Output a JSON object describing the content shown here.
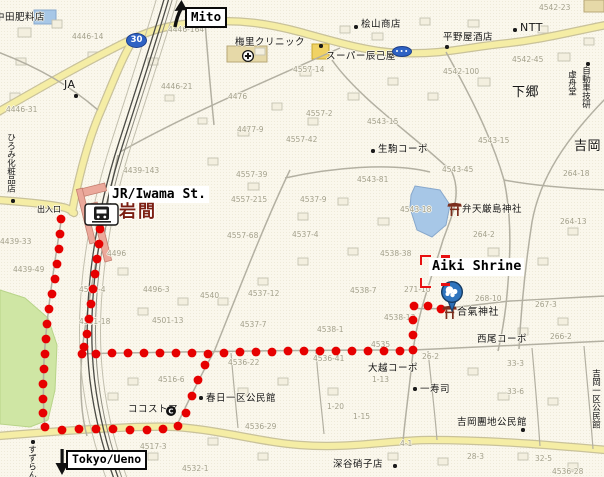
{
  "map": {
    "labels": {
      "station_en": "JR/Iwama St.",
      "shrine_en": "Aiki Shrine",
      "north": "Mito",
      "south": "Tokyo/Ueno",
      "station_jp": "岩間",
      "entrance": "出入口"
    },
    "badges": {
      "route_30": "30"
    },
    "colors": {
      "route_dot": "#e60000",
      "road_yellow": "#f5eda5",
      "water": "#a7c7e7",
      "park": "#cfe6a4",
      "rail": "#4b4b45",
      "station_name": "#7b1e12",
      "badge_blue": "#2e62c4"
    },
    "pois": [
      {
        "text": "中田肥料店",
        "x": -5,
        "y": 13
      },
      {
        "text": "JA",
        "x": 64,
        "y": 79,
        "size": 11,
        "dot": [
          76,
          96
        ]
      },
      {
        "text": "桧山商店",
        "x": 361,
        "y": 20,
        "dot": [
          356,
          27
        ]
      },
      {
        "text": "スーパー辰己屋",
        "x": 326,
        "y": 52,
        "dot": [
          321,
          46
        ]
      },
      {
        "text": "平野屋酒店",
        "x": 443,
        "y": 33,
        "dot": [
          447,
          47
        ]
      },
      {
        "text": "NTT",
        "x": 520,
        "y": 22,
        "size": 11,
        "dot": [
          515,
          30
        ]
      },
      {
        "text": "梅里クリニック",
        "x": 235,
        "y": 38
      },
      {
        "text": "下郷",
        "x": 512,
        "y": 86,
        "size": 13
      },
      {
        "text": "自動車技研",
        "x": 581,
        "y": 66,
        "v": true,
        "size": 8.5,
        "dot": [
          588,
          64
        ]
      },
      {
        "text": "虚舟堂",
        "x": 567,
        "y": 70,
        "v": true,
        "size": 8.5
      },
      {
        "text": "吉岡",
        "x": 574,
        "y": 140,
        "size": 13
      },
      {
        "text": "生駒コーポ",
        "x": 378,
        "y": 145,
        "dot": [
          373,
          151
        ]
      },
      {
        "text": "ひろみ化粧品店",
        "x": 6,
        "y": 133,
        "v": true,
        "size": 8.5,
        "dot": [
          13,
          201
        ]
      },
      {
        "text": "弁天厳島神社",
        "x": 462,
        "y": 205
      },
      {
        "text": "合氣神社",
        "x": 457,
        "y": 308,
        "size": 10
      },
      {
        "text": "西尾コーポ",
        "x": 477,
        "y": 335
      },
      {
        "text": "大越コーポ",
        "x": 368,
        "y": 364
      },
      {
        "text": "一寿司",
        "x": 420,
        "y": 385,
        "dot": [
          415,
          389
        ]
      },
      {
        "text": "吉岡團地公民館",
        "x": 457,
        "y": 418,
        "dot": [
          523,
          430
        ]
      },
      {
        "text": "吉岡一区公民館",
        "x": 591,
        "y": 369,
        "v": true,
        "size": 8.5
      },
      {
        "text": "春日一区公民館",
        "x": 206,
        "y": 394,
        "dot": [
          201,
          398
        ]
      },
      {
        "text": "ココストア",
        "x": 128,
        "y": 405
      },
      {
        "text": "深谷硝子店",
        "x": 333,
        "y": 460,
        "dot": [
          395,
          466
        ]
      },
      {
        "text": "すずらん",
        "x": 27,
        "y": 445,
        "v": true,
        "size": 8.5,
        "dot": [
          33,
          442
        ]
      }
    ],
    "plot_numbers": [
      {
        "text": "4446-14",
        "x": 72,
        "y": 33
      },
      {
        "text": "4446-164",
        "x": 168,
        "y": 26
      },
      {
        "text": "4446-21",
        "x": 161,
        "y": 83
      },
      {
        "text": "4476",
        "x": 228,
        "y": 93
      },
      {
        "text": "4446-31",
        "x": 6,
        "y": 106
      },
      {
        "text": "4557-14",
        "x": 293,
        "y": 66
      },
      {
        "text": "4557-2",
        "x": 306,
        "y": 110
      },
      {
        "text": "4542-23",
        "x": 539,
        "y": 4
      },
      {
        "text": "4542-45",
        "x": 512,
        "y": 56
      },
      {
        "text": "4542-100",
        "x": 443,
        "y": 68
      },
      {
        "text": "4439-143",
        "x": 123,
        "y": 167
      },
      {
        "text": "4477-9",
        "x": 237,
        "y": 126
      },
      {
        "text": "4557-42",
        "x": 286,
        "y": 136
      },
      {
        "text": "4557-39",
        "x": 236,
        "y": 171
      },
      {
        "text": "4557-215",
        "x": 231,
        "y": 196
      },
      {
        "text": "4557-68",
        "x": 227,
        "y": 232
      },
      {
        "text": "4543-15",
        "x": 367,
        "y": 118
      },
      {
        "text": "4543-15",
        "x": 478,
        "y": 137
      },
      {
        "text": "4543-81",
        "x": 357,
        "y": 176
      },
      {
        "text": "4543-45",
        "x": 442,
        "y": 166
      },
      {
        "text": "4543-18",
        "x": 400,
        "y": 206
      },
      {
        "text": "4537-9",
        "x": 300,
        "y": 196
      },
      {
        "text": "4537-4",
        "x": 292,
        "y": 231
      },
      {
        "text": "264-18",
        "x": 563,
        "y": 170
      },
      {
        "text": "264-13",
        "x": 560,
        "y": 218
      },
      {
        "text": "264-2",
        "x": 473,
        "y": 231
      },
      {
        "text": "4538-38",
        "x": 380,
        "y": 250
      },
      {
        "text": "271-10",
        "x": 404,
        "y": 286
      },
      {
        "text": "268-10",
        "x": 475,
        "y": 295
      },
      {
        "text": "267-3",
        "x": 535,
        "y": 301
      },
      {
        "text": "266-2",
        "x": 550,
        "y": 333
      },
      {
        "text": "26-2",
        "x": 422,
        "y": 353
      },
      {
        "text": "4538-13",
        "x": 384,
        "y": 314
      },
      {
        "text": "4538-7",
        "x": 350,
        "y": 287
      },
      {
        "text": "4538-1",
        "x": 317,
        "y": 326
      },
      {
        "text": "4535",
        "x": 371,
        "y": 341
      },
      {
        "text": "4536-41",
        "x": 313,
        "y": 355
      },
      {
        "text": "4536-22",
        "x": 228,
        "y": 359
      },
      {
        "text": "4516-6",
        "x": 158,
        "y": 376
      },
      {
        "text": "4536-29",
        "x": 245,
        "y": 423
      },
      {
        "text": "4517-3",
        "x": 140,
        "y": 443
      },
      {
        "text": "4532-1",
        "x": 182,
        "y": 465
      },
      {
        "text": "4536-28",
        "x": 552,
        "y": 468
      },
      {
        "text": "33-3",
        "x": 507,
        "y": 360
      },
      {
        "text": "33-6",
        "x": 507,
        "y": 388
      },
      {
        "text": "1-13",
        "x": 372,
        "y": 376
      },
      {
        "text": "1-20",
        "x": 327,
        "y": 403
      },
      {
        "text": "1-15",
        "x": 353,
        "y": 413
      },
      {
        "text": "4-1",
        "x": 400,
        "y": 440
      },
      {
        "text": "28-3",
        "x": 467,
        "y": 453
      },
      {
        "text": "32-5",
        "x": 535,
        "y": 455
      },
      {
        "text": "4439-49",
        "x": 13,
        "y": 266
      },
      {
        "text": "4439-33",
        "x": 0,
        "y": 238
      },
      {
        "text": "4496",
        "x": 107,
        "y": 250
      },
      {
        "text": "4501-4",
        "x": 79,
        "y": 286
      },
      {
        "text": "4496-3",
        "x": 143,
        "y": 286
      },
      {
        "text": "4540",
        "x": 200,
        "y": 292
      },
      {
        "text": "4537-12",
        "x": 248,
        "y": 290
      },
      {
        "text": "4501-18",
        "x": 79,
        "y": 318
      },
      {
        "text": "4501-13",
        "x": 152,
        "y": 317
      },
      {
        "text": "4537-7",
        "x": 240,
        "y": 321
      }
    ],
    "icons": [
      {
        "type": "train-station",
        "x": 85,
        "y": 204
      },
      {
        "type": "torii",
        "x": 448,
        "y": 204
      },
      {
        "type": "torii",
        "x": 443,
        "y": 307
      },
      {
        "type": "pin",
        "x": 452,
        "y": 292
      },
      {
        "type": "hospital",
        "x": 248,
        "y": 56
      },
      {
        "type": "circle-c",
        "x": 171,
        "y": 411,
        "glyph": "C"
      }
    ],
    "route": {
      "color": "#e60000",
      "dot_radius": 4.4,
      "lines": [
        [
          [
            61,
            219
          ],
          [
            60,
            234
          ],
          [
            59,
            249
          ],
          [
            57,
            264
          ],
          [
            55,
            279
          ],
          [
            52,
            294
          ],
          [
            49,
            309
          ],
          [
            47,
            324
          ],
          [
            46,
            339
          ],
          [
            45,
            354
          ],
          [
            44,
            369
          ],
          [
            43,
            384
          ],
          [
            43,
            399
          ],
          [
            43,
            413
          ],
          [
            45,
            427
          ],
          [
            62,
            430
          ],
          [
            79,
            429
          ],
          [
            96,
            429
          ],
          [
            113,
            429
          ],
          [
            130,
            430
          ],
          [
            147,
            430
          ],
          [
            163,
            429
          ],
          [
            178,
            426
          ],
          [
            186,
            413
          ],
          [
            192,
            396
          ],
          [
            198,
            380
          ],
          [
            205,
            365
          ]
        ],
        [
          [
            100,
            229
          ],
          [
            99,
            244
          ],
          [
            97,
            259
          ],
          [
            95,
            274
          ],
          [
            93,
            289
          ],
          [
            91,
            304
          ],
          [
            89,
            319
          ],
          [
            87,
            334
          ],
          [
            84,
            347
          ],
          [
            82,
            354
          ],
          [
            96,
            354
          ],
          [
            112,
            353
          ],
          [
            128,
            353
          ],
          [
            144,
            353
          ],
          [
            160,
            353
          ],
          [
            176,
            353
          ],
          [
            192,
            353
          ],
          [
            208,
            354
          ],
          [
            224,
            353
          ],
          [
            240,
            352
          ],
          [
            256,
            352
          ],
          [
            272,
            352
          ],
          [
            288,
            351
          ],
          [
            304,
            351
          ],
          [
            320,
            351
          ],
          [
            336,
            351
          ],
          [
            352,
            351
          ],
          [
            368,
            351
          ],
          [
            384,
            351
          ],
          [
            400,
            351
          ],
          [
            413,
            350
          ],
          [
            413,
            335
          ],
          [
            413,
            320
          ],
          [
            414,
            306
          ],
          [
            428,
            306
          ],
          [
            441,
            309
          ]
        ]
      ]
    }
  }
}
